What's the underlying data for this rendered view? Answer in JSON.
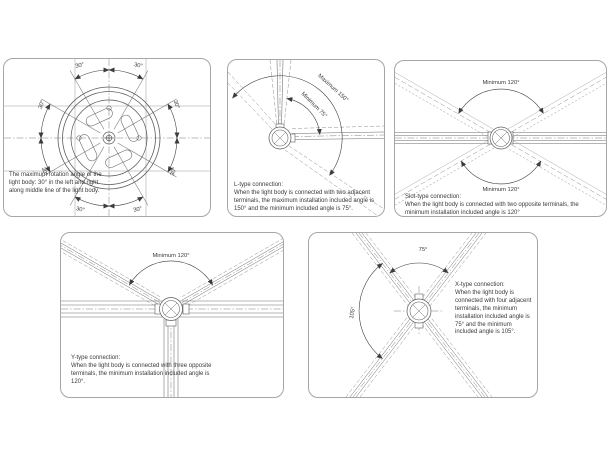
{
  "colors": {
    "line": "#6a6a6a",
    "construction": "#8f8f8f",
    "arc": "#3c3c3c",
    "text": "#3a3a3a",
    "panel_border": "#a6a6a6"
  },
  "panels": {
    "rotation": {
      "note": "The maximum rotation angle of the light body: 30° in the left and right along middle line of the light body.",
      "angle_labels": [
        "30°",
        "30°",
        "30°",
        "30°",
        "30°",
        "30°",
        "30°",
        "30°"
      ]
    },
    "l_type": {
      "arc_label_max": "Maximum 150°",
      "arc_label_min": "Minimum 75°",
      "title": "L-type connection:",
      "body": "When the light body is connected with two adjacent terminals, the maximum installation included angle is 150° and the minimum included angle is 75°."
    },
    "slot_type": {
      "arc_label_top": "Minimum 120°",
      "arc_label_bottom": "Minimum 120°",
      "title": "Slot-type connection:",
      "body": "When the light body is connected with two opposite terminals, the minimum installation included angle is 120°"
    },
    "y_type": {
      "arc_label": "Minimum 120°",
      "title": "Y-type connection:",
      "body": "When the light body is connected with three opposite terminals, the minimum installation included angle is 120°."
    },
    "x_type": {
      "arc_label_top": "75°",
      "arc_label_left": "105°",
      "title": "X-type connection:",
      "body": "When the light body is connected with four adjacent terminals, the minimum installation included angle is 75° and the minimum included angle is 105°."
    }
  }
}
